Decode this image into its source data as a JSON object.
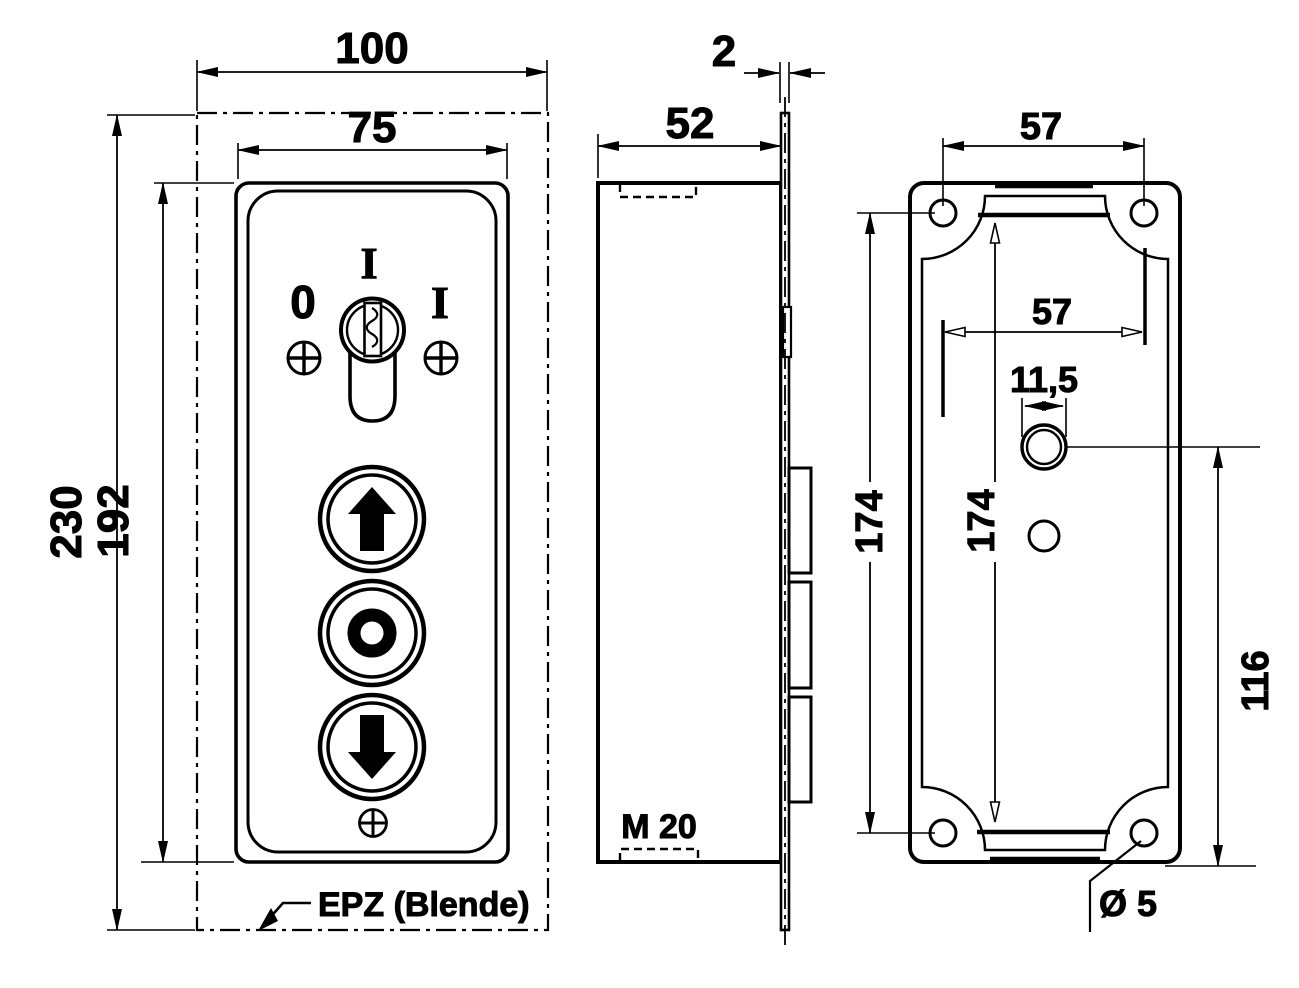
{
  "drawing": {
    "front": {
      "dim_overall_width": "100",
      "dim_panel_width": "75",
      "dim_overall_height": "230",
      "dim_panel_height": "192",
      "key_pos_top": "I",
      "key_pos_off": "0",
      "key_pos_on": "I",
      "cover_label": "EPZ (Blende)"
    },
    "side": {
      "dim_depth": "52",
      "dim_plate_thickness": "2",
      "gland_label": "M 20"
    },
    "back": {
      "dim_hole_spacing_w": "57",
      "dim_inner_w": "57",
      "dim_hole_spacing_h": "174",
      "dim_inner_h": "174",
      "dim_gland_dia": "11,5",
      "dim_hole_offset": "116",
      "dim_screw_hole": "Ø 5"
    },
    "colors": {
      "line": "#000000",
      "background": "#ffffff"
    }
  }
}
